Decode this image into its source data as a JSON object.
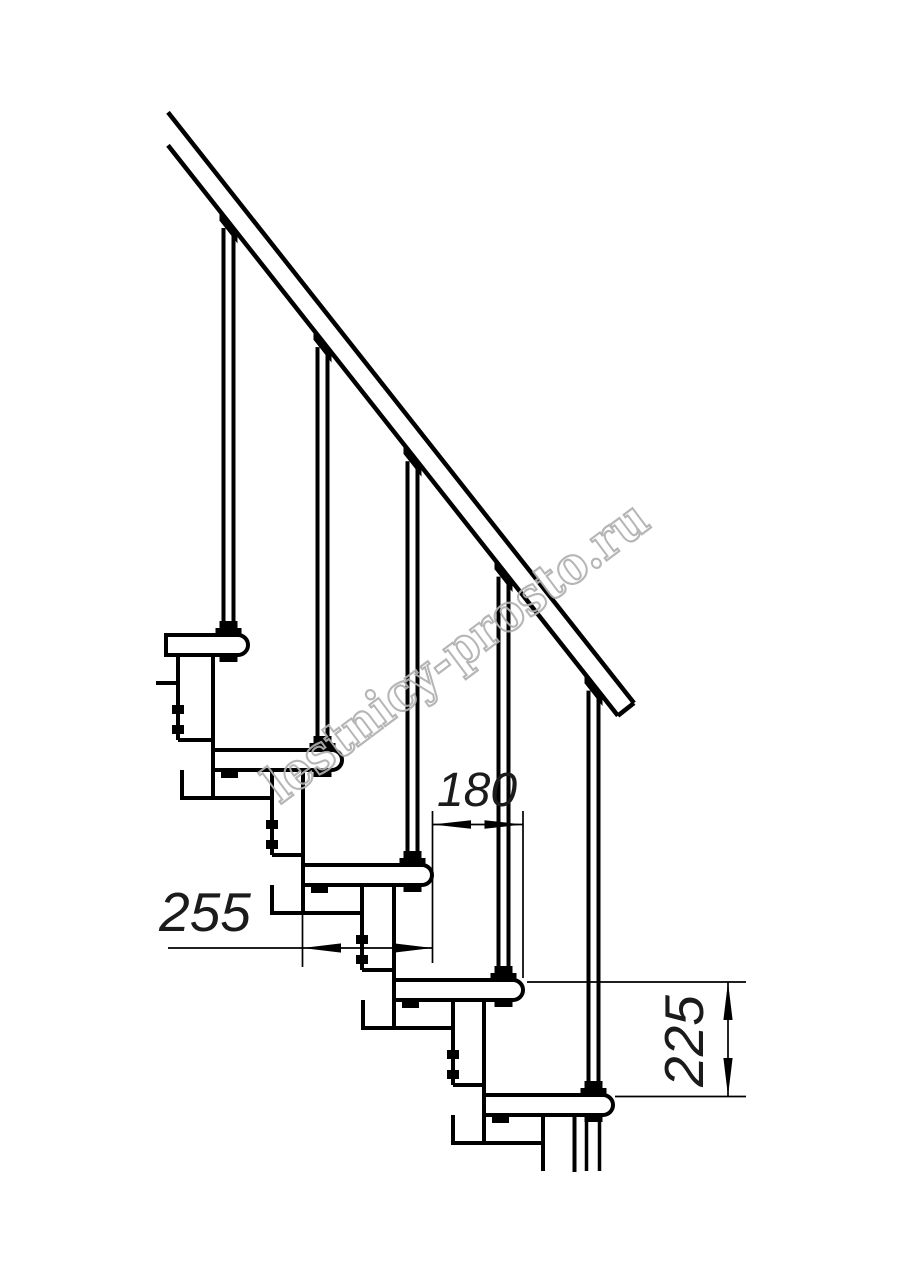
{
  "colors": {
    "background": "#ffffff",
    "line": "#000000",
    "dimension_text": "#1b1b1b",
    "watermark": "#b0b0b0"
  },
  "drawing": {
    "type": "staircase side elevation, modular stair with handrail and balusters",
    "dimensions": {
      "run": "180",
      "tread": "255",
      "rise": "225"
    },
    "watermark": "lestnicy-prosto.ru"
  }
}
